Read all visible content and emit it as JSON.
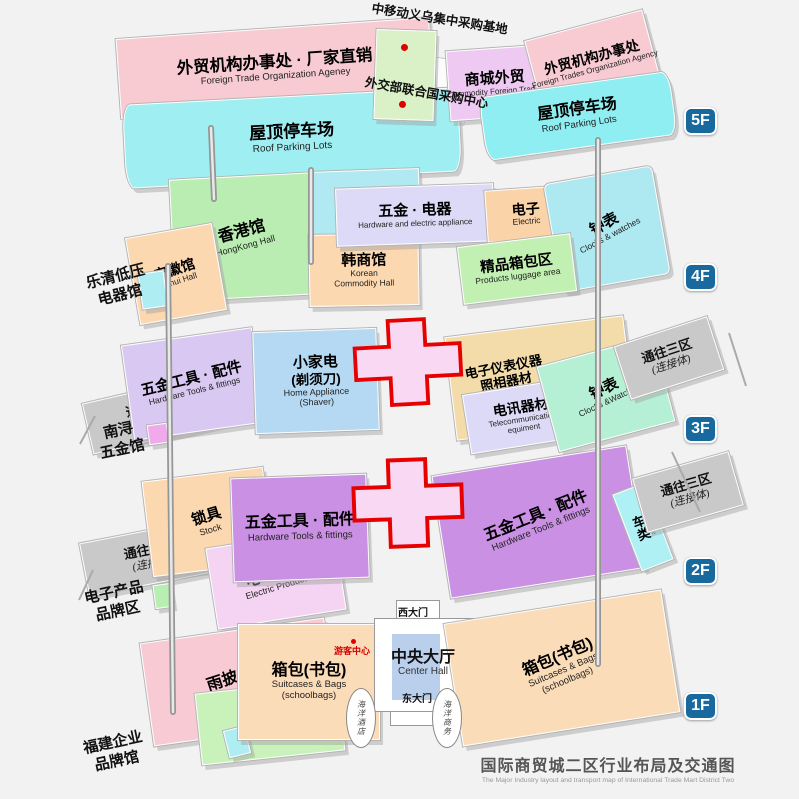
{
  "meta": {
    "title_zh": "国际商贸城二区行业布局及交通图",
    "title_en": "The Major Industry layout and transport map of International Trade Mart District Two"
  },
  "badges": {
    "f5": "5F",
    "f4": "4F",
    "f3": "3F",
    "f2": "2F",
    "f1": "1F"
  },
  "f5": {
    "trade_office_left": {
      "zh": "外贸机构办事处 · 厂家直销",
      "en": "Foreign Trade Organization Ageney"
    },
    "roof_parking": {
      "zh": "屋顶停车场",
      "en": "Roof Parking Lots"
    },
    "mobile_base": {
      "zh": "中移动义乌集中采购基地"
    },
    "un_center": {
      "zh": "外交部联合国采购中心"
    },
    "mall_foreign_trade": {
      "zh": "商城外贸",
      "en": "Commodity Foreign Trades"
    },
    "trade_office_right": {
      "zh": "外贸机构办事处",
      "en": "Foreign Trades Organization Agency"
    }
  },
  "f4": {
    "hongkong": {
      "zh": "香港馆",
      "en": "HongKong Hall"
    },
    "sichuan": {
      "zh": "四川馆",
      "en": "Sichuan Hall"
    },
    "anhui": {
      "zh": "安徽馆",
      "en": "Anhui Hall"
    },
    "korean": {
      "zh": "韩商馆",
      "en1": "Korean",
      "en2": "Commodity Hall"
    },
    "hardware_electric": {
      "zh": "五金 · 电器",
      "en": "Hardware and electric appliance"
    },
    "electric": {
      "zh": "电子",
      "en": "Electric"
    },
    "clocks": {
      "zh": "钟表",
      "en": "Clocks & watches"
    },
    "luggage": {
      "zh": "精品箱包区",
      "en": "Products luggage area"
    }
  },
  "f3": {
    "hardware_tools": {
      "zh": "五金工具 · 配件",
      "en": "Hardware Tools & fittings"
    },
    "home_appliance": {
      "zh1": "小家电",
      "zh2": "(剃须刀)",
      "en1": "Home Appliance",
      "en2": "(Shaver)"
    },
    "instruments": {
      "zh1": "电子仪表仪器",
      "zh2": "照相器材",
      "zh3": "电池 · 灯 · 电筒",
      "en": "Tourism & Shopping of Enterprise"
    },
    "telecom": {
      "zh": "电讯器材",
      "en1": "Telecommunication",
      "en2": "equiment"
    },
    "clocks": {
      "zh": "钟表",
      "en": "Clocks &Watches"
    }
  },
  "f2": {
    "locks": {
      "zh": "锁具",
      "en": "Stock"
    },
    "electric_products": {
      "zh": "电工产品",
      "en": "Electric Products"
    },
    "hardware_tools": {
      "zh": "五金工具 · 配件",
      "en": "Hardware Tools & fittings"
    },
    "vehicles": {
      "zh": "车类",
      "en": "Vehicle"
    }
  },
  "f1": {
    "rainwear": {
      "zh": "雨披 · 袋",
      "en": "Rainwear & Poly Bags"
    },
    "umbrellas": {
      "zh": "伞具",
      "en": "Umbrellas"
    },
    "suitcases": {
      "zh": "箱包(书包)",
      "en1": "Suitcases & Bags",
      "en2": "(schoolbags)"
    },
    "center_hall": {
      "zh": "中央大厅",
      "en": "Center Hall"
    },
    "west_gate": "西大门",
    "east_gate": "东大门",
    "visitor_center": "游客中心",
    "ocean_hotel": "海洋酒店",
    "ocean_business": "海洋商务"
  },
  "connectors": {
    "to_d1": {
      "zh": "通往一区",
      "sub": "(连接体)"
    },
    "to_d3": {
      "zh": "通往三区",
      "sub": "(连接体)"
    }
  },
  "side_labels": {
    "yueqing": {
      "line1": "乐清低压",
      "line2": "电器馆"
    },
    "nanxun": {
      "line1": "南浔",
      "line2": "五金馆"
    },
    "ezone": {
      "line1": "电子产品",
      "line2": "品牌区"
    },
    "fujian": {
      "line1": "福建企业",
      "line2": "品牌馆"
    }
  },
  "colors": {
    "badge_blue": "#17699e",
    "cross_red": "#e60000",
    "dot_red": "#e00000",
    "pink": "#f8cbd2",
    "cyan": "#9feef2",
    "green": "#b9edb1",
    "lavender": "#dcdaf6",
    "peach": "#fbd8b0",
    "purple": "#ca90e4",
    "tan": "#f3dcaa",
    "blue": "#b6d9f3",
    "mint": "#b5f0d4",
    "violet": "#eec9f2",
    "gray_connector": "#c9c9c9",
    "hall_blue": "#b9cfec"
  }
}
